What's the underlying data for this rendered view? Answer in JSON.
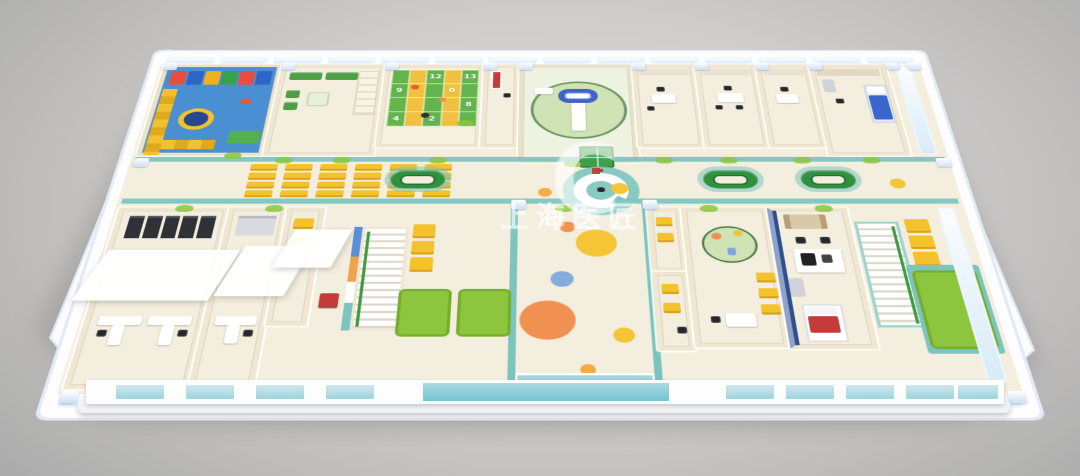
{
  "watermark": {
    "brand_text": "上海医匠",
    "logo_letter": "C"
  },
  "hopscotch_mat": {
    "rows": 4,
    "cols": 5,
    "numbers": {
      "2": "12",
      "4": "13",
      "5": "9",
      "8": "0",
      "14": "8",
      "15": "4",
      "17": "2"
    }
  },
  "waiting_area": {
    "chair_rows": 4,
    "chair_cols": 6
  },
  "hall_dots": [
    {
      "x": 430,
      "y": 242,
      "r": 7,
      "color": "#f2a63c"
    },
    {
      "x": 506,
      "y": 236,
      "r": 9,
      "color": "#f4c22c"
    },
    {
      "x": 452,
      "y": 296,
      "r": 8,
      "color": "#ef8b4a"
    },
    {
      "x": 480,
      "y": 320,
      "r": 20,
      "color": "#f4c22c"
    },
    {
      "x": 446,
      "y": 372,
      "r": 11,
      "color": "#7fa7dc"
    },
    {
      "x": 432,
      "y": 428,
      "r": 26,
      "color": "#ef8b4a"
    },
    {
      "x": 502,
      "y": 448,
      "r": 10,
      "color": "#f4c22c"
    },
    {
      "x": 468,
      "y": 492,
      "r": 7,
      "color": "#f2a63c"
    },
    {
      "x": 790,
      "y": 228,
      "r": 8,
      "color": "#f4c22c"
    }
  ],
  "palette": {
    "bg-center": "#d8d7d5",
    "bg-edge": "#a9a9a9",
    "floor": "#f3eedd",
    "wall": "#efe7d2",
    "teal": "#7cc5bf",
    "glass": "#d9ebf8",
    "glass-frame": "#eef5fc",
    "pillar": "#cfdef5",
    "chair-yellow": "#f4c22c",
    "chair-yellow-dark": "#d9a31c",
    "green-dark": "#2f9140",
    "green": "#4f9f45",
    "green-light": "#8cc63f",
    "green-pale": "#cfe3b4",
    "blue-play": "#4b8fd3",
    "blue-bed": "#3a66cc",
    "orange": "#ef8b4a",
    "red": "#c43b3b",
    "navy": "#2f4f8f"
  }
}
